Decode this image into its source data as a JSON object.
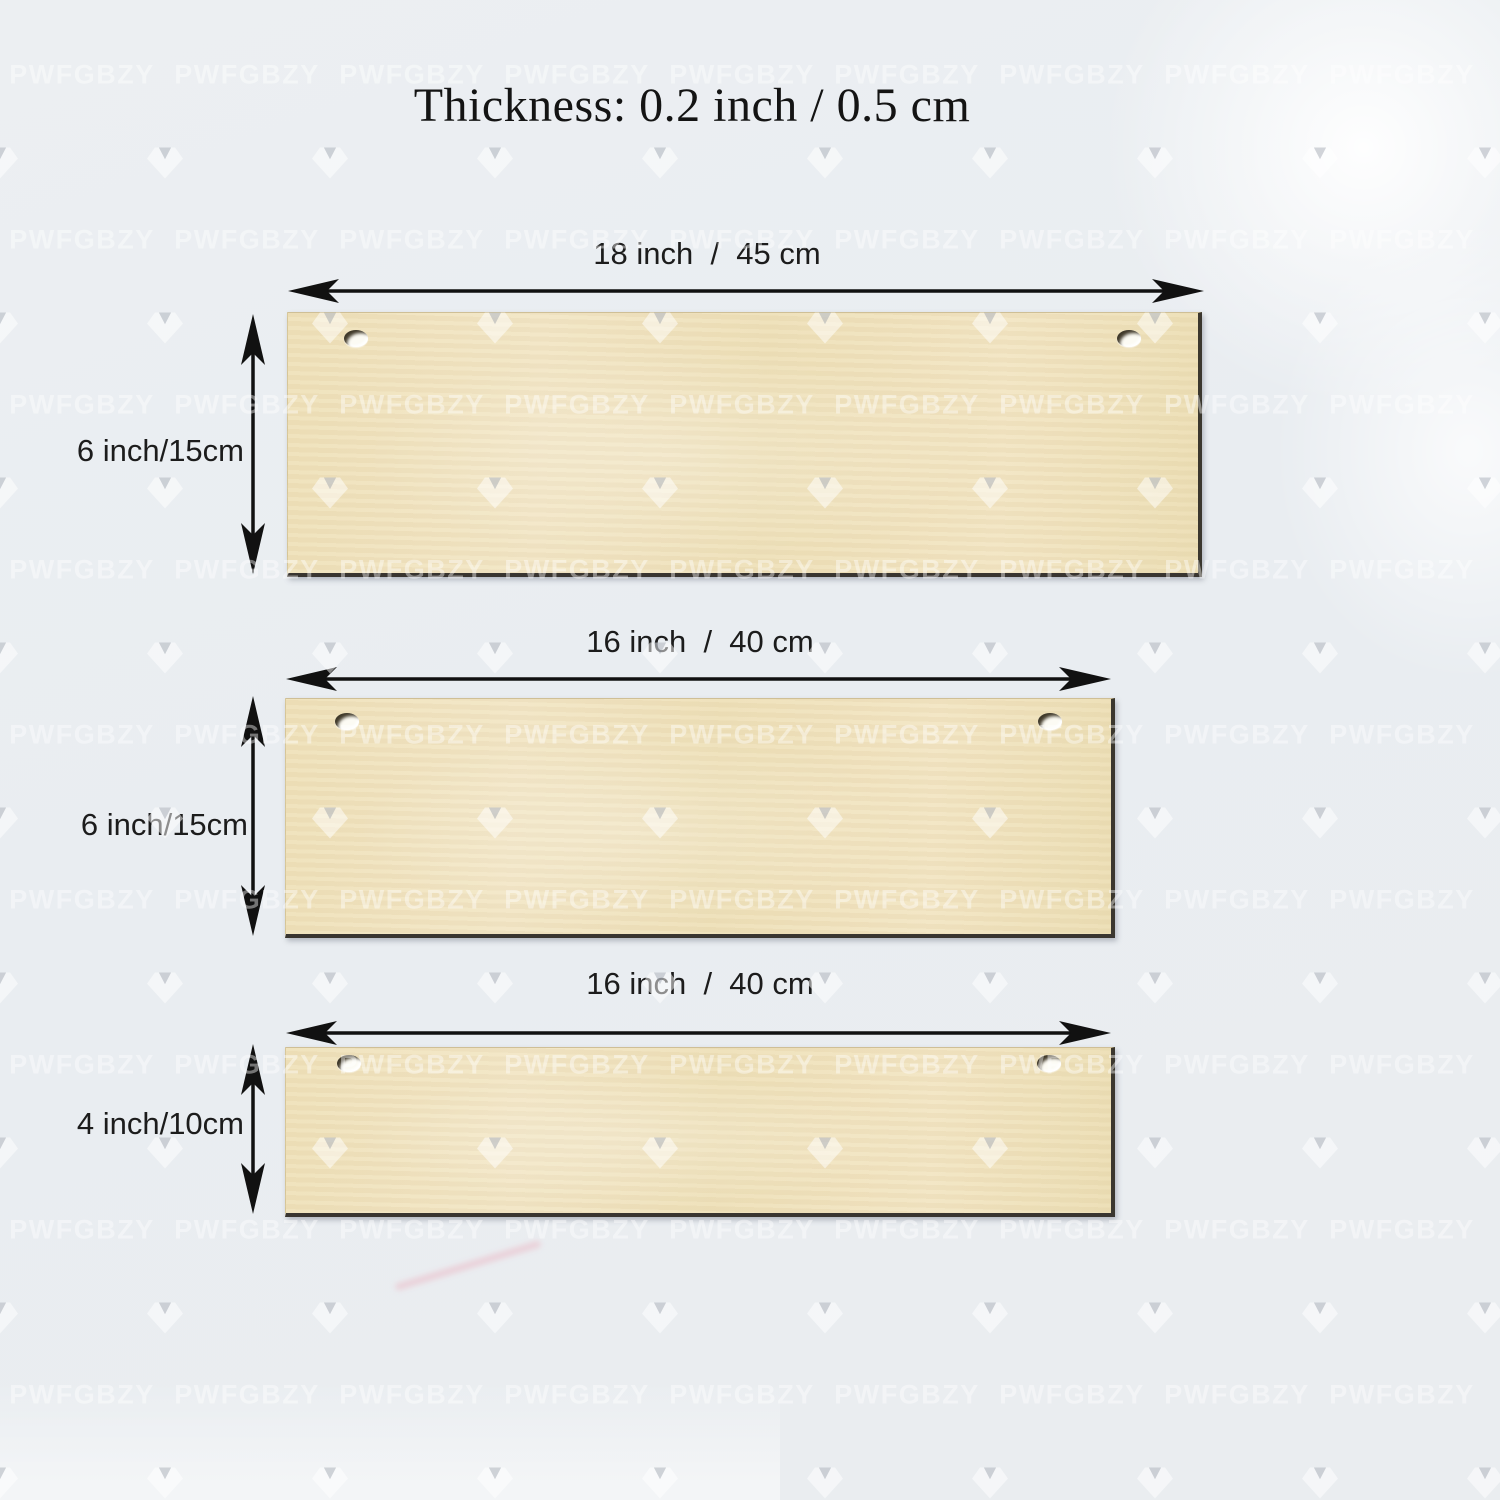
{
  "title": "Thickness: 0.2 inch / 0.5 cm",
  "watermark": {
    "text": "PWFGBZY",
    "icon": "gem-icon"
  },
  "colors": {
    "background": "#eaedf1",
    "plaque": "#f0e3c0",
    "plaque_edge": "#3a362e",
    "arrow": "#111111",
    "label_text": "#1c1c1c"
  },
  "plaques": [
    {
      "name": "plaque-18x6",
      "width_label": "18 inch  /  45 cm",
      "height_label": "6 inch/15cm"
    },
    {
      "name": "plaque-16x6",
      "width_label": "16 inch  /  40 cm",
      "height_label": "6 inch/15cm"
    },
    {
      "name": "plaque-16x4",
      "width_label": "16 inch  /  40 cm",
      "height_label": "4 inch/10cm"
    }
  ]
}
